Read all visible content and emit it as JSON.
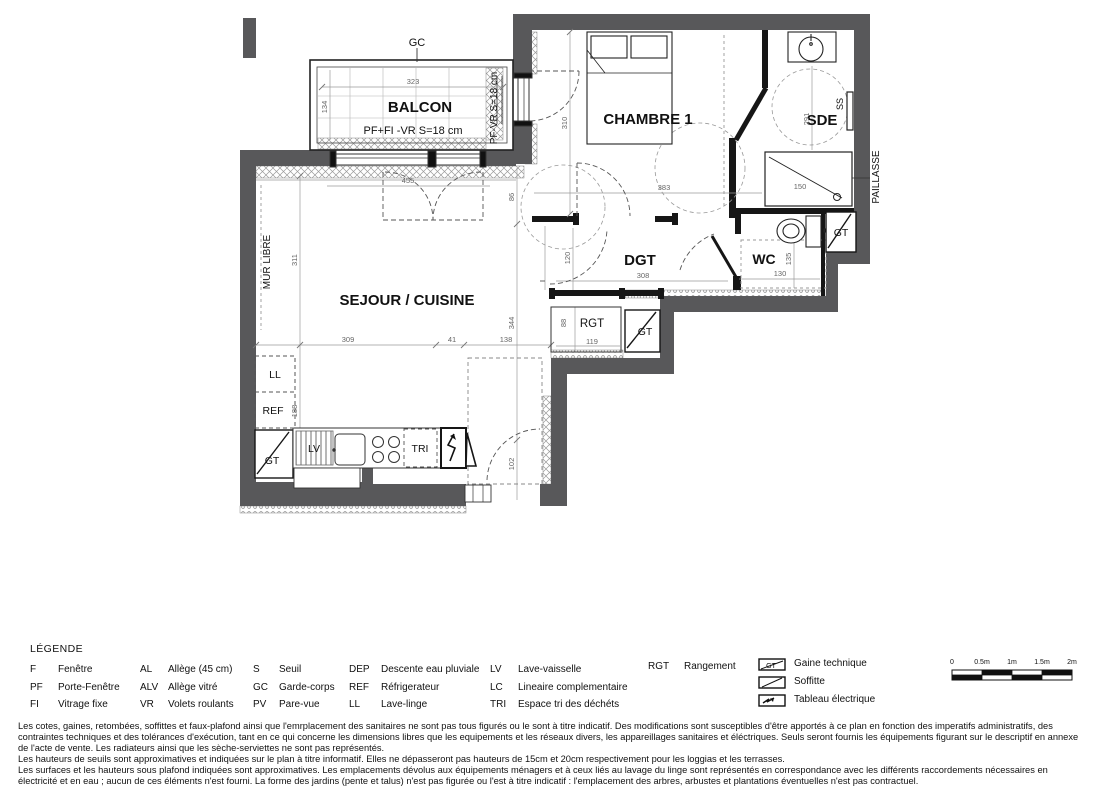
{
  "plan": {
    "rooms": {
      "balcon": "BALCON",
      "chambre": "CHAMBRE 1",
      "sde": "SDE",
      "dgt": "DGT",
      "wc": "WC",
      "sejour": "SEJOUR / CUISINE",
      "rgt": "RGT"
    },
    "annotations": {
      "gc": "GC",
      "balcon_note": "PF+FI -VR   S=18 cm",
      "pf_vr": "PF-VR   S=18 cm",
      "ss": "SS",
      "paillasse": "PAILLASSE",
      "mur_libre": "MUR LIBRE",
      "gt": "GT",
      "ll": "LL",
      "ref": "REF",
      "lv": "LV",
      "tri": "TRI"
    },
    "dims": {
      "balcon_w": "323",
      "balcon_d": "134",
      "pf_w": "455",
      "d86": "86",
      "chambre_h": "310",
      "chambre_w": "383",
      "sde_h": "291",
      "douche_w": "150",
      "dgt_h": "120",
      "dgt_w": "308",
      "wc_h": "135",
      "wc_w": "130",
      "rgt_h": "88",
      "rgt_w": "119",
      "sejour_h": "311",
      "k1": "309",
      "k2": "41",
      "k3": "138",
      "d344": "344",
      "cuisine_h": "188",
      "entree_h": "102"
    }
  },
  "legend": {
    "title": "LÉGENDE",
    "columns": [
      {
        "items": [
          {
            "abbr": "F",
            "label": "Fenêtre"
          },
          {
            "abbr": "PF",
            "label": "Porte-Fenêtre"
          },
          {
            "abbr": "FI",
            "label": "Vitrage fixe"
          }
        ]
      },
      {
        "items": [
          {
            "abbr": "AL",
            "label": "Allège (45 cm)"
          },
          {
            "abbr": "ALV",
            "label": "Allège vitré"
          },
          {
            "abbr": "VR",
            "label": "Volets roulants"
          }
        ]
      },
      {
        "items": [
          {
            "abbr": "S",
            "label": "Seuil"
          },
          {
            "abbr": "GC",
            "label": "Garde-corps"
          },
          {
            "abbr": "PV",
            "label": "Pare-vue"
          }
        ]
      },
      {
        "items": [
          {
            "abbr": "DEP",
            "label": "Descente eau pluviale"
          },
          {
            "abbr": "REF",
            "label": "Réfrigerateur"
          },
          {
            "abbr": "LL",
            "label": "Lave-linge"
          }
        ]
      },
      {
        "items": [
          {
            "abbr": "LV",
            "label": "Lave-vaisselle"
          },
          {
            "abbr": "LC",
            "label": "Lineaire complementaire"
          },
          {
            "abbr": "TRI",
            "label": "Espace tri des déchéts"
          }
        ]
      },
      {
        "items": [
          {
            "abbr": "RGT",
            "label": "Rangement"
          }
        ]
      }
    ],
    "symbols": [
      {
        "label": "Gaine technique",
        "tag": "GT"
      },
      {
        "label": "Soffitte"
      },
      {
        "label": "Tableau électrique"
      }
    ],
    "scale_ticks": [
      "0",
      "0.5m",
      "1m",
      "1.5m",
      "2m"
    ]
  },
  "footer": {
    "paragraphs": [
      "Les cotes, gaines, retombées, soffittes et faux-plafond ainsi que l'emrplacement des sanitaires ne sont  pas tous figurés ou le sont à titre indicatif. Des modifications sont susceptibles d'être apportés à ce plan en fonction des imperatifs administratifs, des contraintes techniques et des tolérances d'exécution, tant en ce qui concerne les dimensions libres que les equipements et les réseaux divers, les appareillages sanitaires et éléctriques. Seuls seront fournis les équipements figurant sur le descriptif en annexe de l'acte de vente. Les radiateurs ainsi que les sèche-serviettes ne sont pas représentés.",
      "Les hauteurs de seuils sont approximatives et indiquées sur le plan à titre informatif. Elles ne dépasseront pas hauteurs de 15cm et 20cm respectivement pour les loggias et les terrasses.",
      "Les surfaces et les hauteurs sous plafond indiquées sont approximatives. Les emplacements dévolus aux équipements ménagers et à ceux liés au lavage du linge sont représentés en correspondance avec les différents raccordements nécessaires en électricité et en eau ; aucun de ces éléments n'est fourni. La forme des jardins (pente et talus) n'est pas figurée ou l'est à titre indicatif : l'emplacement des arbres, arbustes et plantations éventuelles n'est pas contractuel."
    ]
  }
}
